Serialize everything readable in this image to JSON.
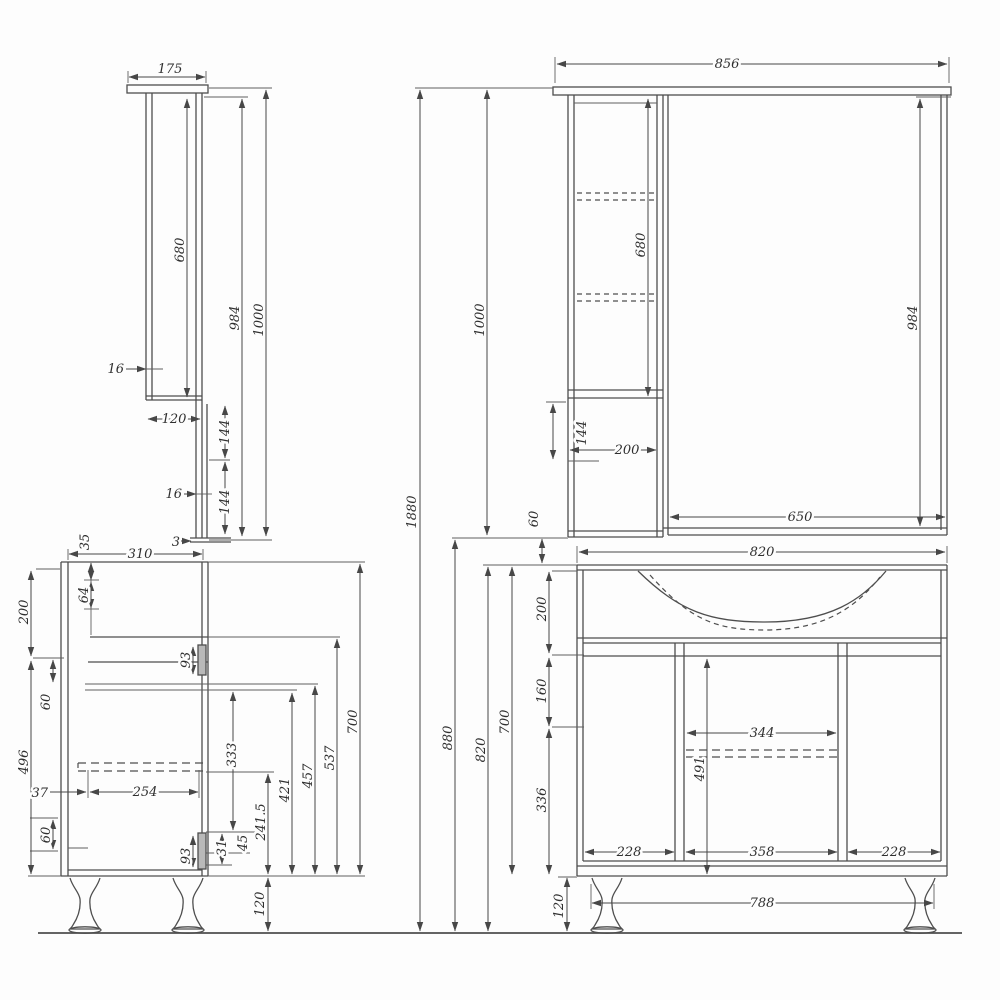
{
  "canvas": {
    "background": "#fdfdfd",
    "line_color": "#4e4e4e",
    "text_color": "#2f2f2f"
  },
  "mirror_side_view": {
    "top_panel_depth": "175",
    "shelf_height": "680",
    "height_below_top": "984",
    "total_height": "1000",
    "top_panel_thickness": "16",
    "body_depth": "120",
    "rail_upper_height": "144",
    "rail_thickness": "16",
    "rail_lower_height": "144",
    "bottom_gap": "3"
  },
  "mirror_front_view": {
    "total_width": "856",
    "shelf_height": "680",
    "height_below_top": "984",
    "total_height": "1000",
    "rail_height": "144",
    "shelf_column_width": "200",
    "mirror_width": "650"
  },
  "assembly": {
    "total_height": "1880",
    "mirror_to_vanity_gap": "60"
  },
  "vanity_side_view": {
    "top_offset": "35",
    "depth": "310",
    "drawer_front_height": "64",
    "upper_section_height": "200",
    "hinge_plate_upper": "93",
    "upper_gap": "60",
    "carcass_height": "496",
    "back_offset": "37",
    "drawer_depth": "254",
    "slide_height": "333",
    "lower_gap": "60",
    "hinge_plate_lower": "93",
    "hinge_offset_31": "31",
    "hinge_offset_45": "45",
    "height_241_5": "241.5",
    "height_421": "421",
    "height_457": "457",
    "height_537": "537",
    "body_height": "700",
    "leg_height": "120"
  },
  "vanity_front_view": {
    "top_width": "820",
    "basin_section_height": "200",
    "under_basin_offset": "160",
    "middle_shelf_width": "344",
    "inner_height": "491",
    "lower_section_height": "336",
    "left_door_width": "228",
    "middle_door_width": "358",
    "right_door_width": "228",
    "leg_span": "788",
    "leg_height": "120",
    "body_height": "700",
    "total_height": "820",
    "height_with_gap": "880"
  }
}
